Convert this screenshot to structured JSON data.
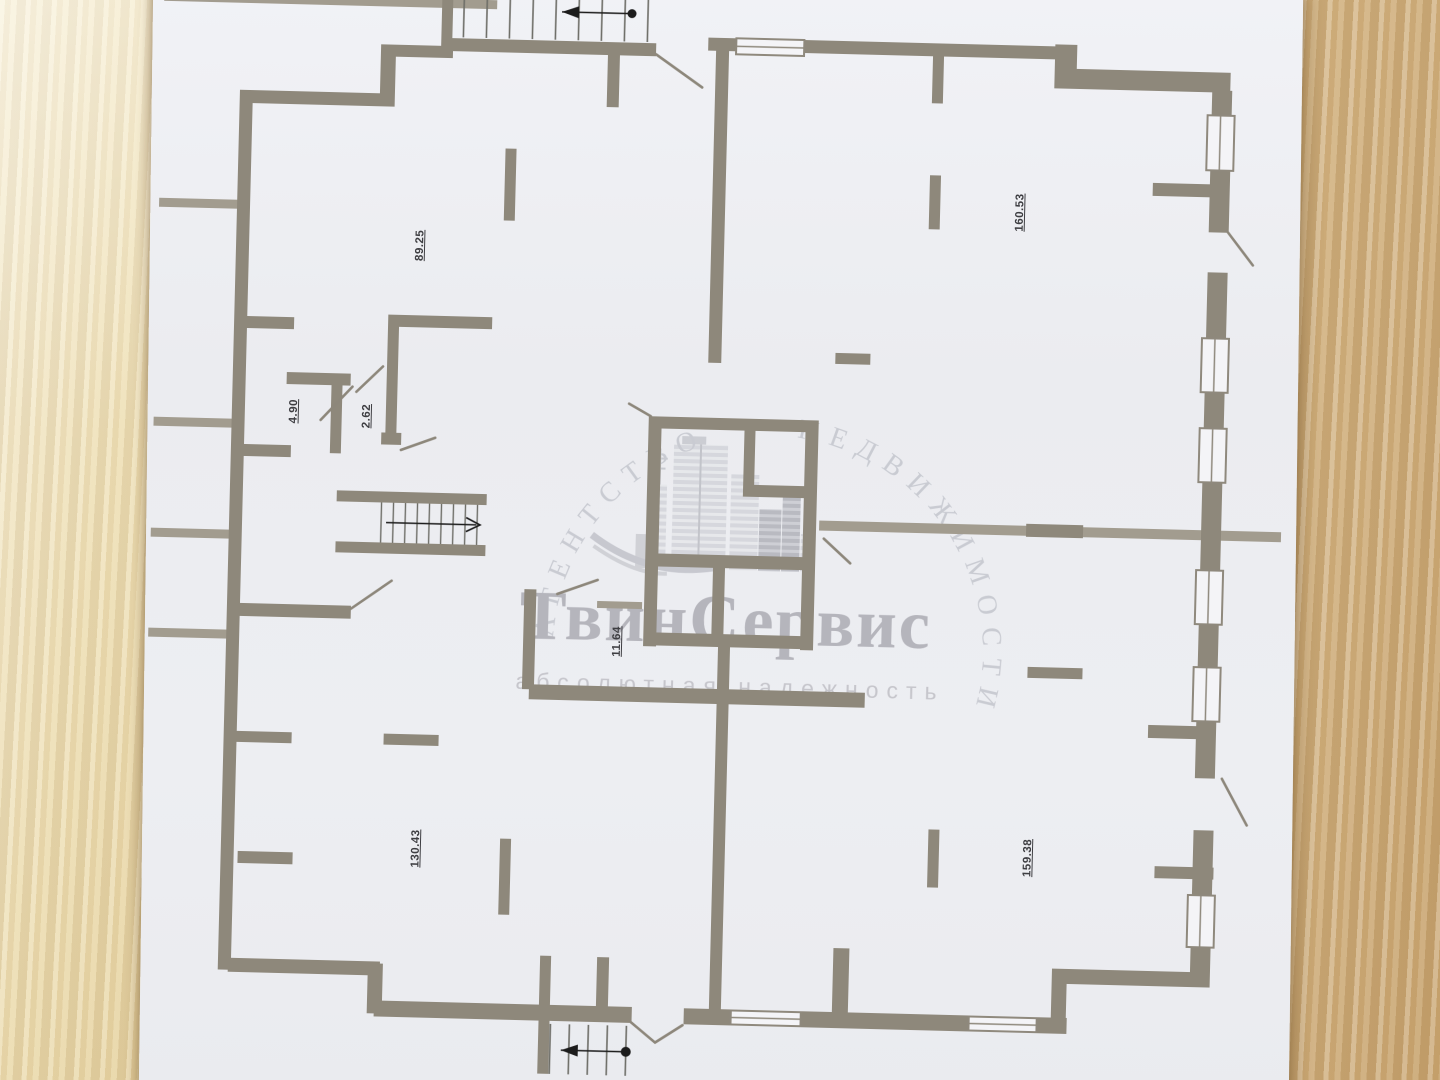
{
  "plan": {
    "room_areas": [
      {
        "name": "room-top-left",
        "area": "89.25"
      },
      {
        "name": "room-top-right",
        "area": "160.53"
      },
      {
        "name": "room-small-left",
        "area": "4.90"
      },
      {
        "name": "room-small-right",
        "area": "2.62"
      },
      {
        "name": "corridor",
        "area": "11.64"
      },
      {
        "name": "room-bottom-left",
        "area": "130.43"
      },
      {
        "name": "room-bottom-right",
        "area": "159.38"
      }
    ]
  },
  "watermark": {
    "arc_text_left": "АГЕНТСТВО",
    "arc_text_right": "НЕДВИЖИМОСТИ",
    "brand": "ТвинСервис",
    "tagline": "абсолютная надежность"
  },
  "colors": {
    "wall": "#8e887b",
    "wall_light": "#a29c8f",
    "paper": "#edeef2",
    "wood_left": "#e9d8a9",
    "wood_right": "#cfae7c",
    "watermark_text": "#b5b5bc",
    "label_text": "#3e3e42"
  }
}
